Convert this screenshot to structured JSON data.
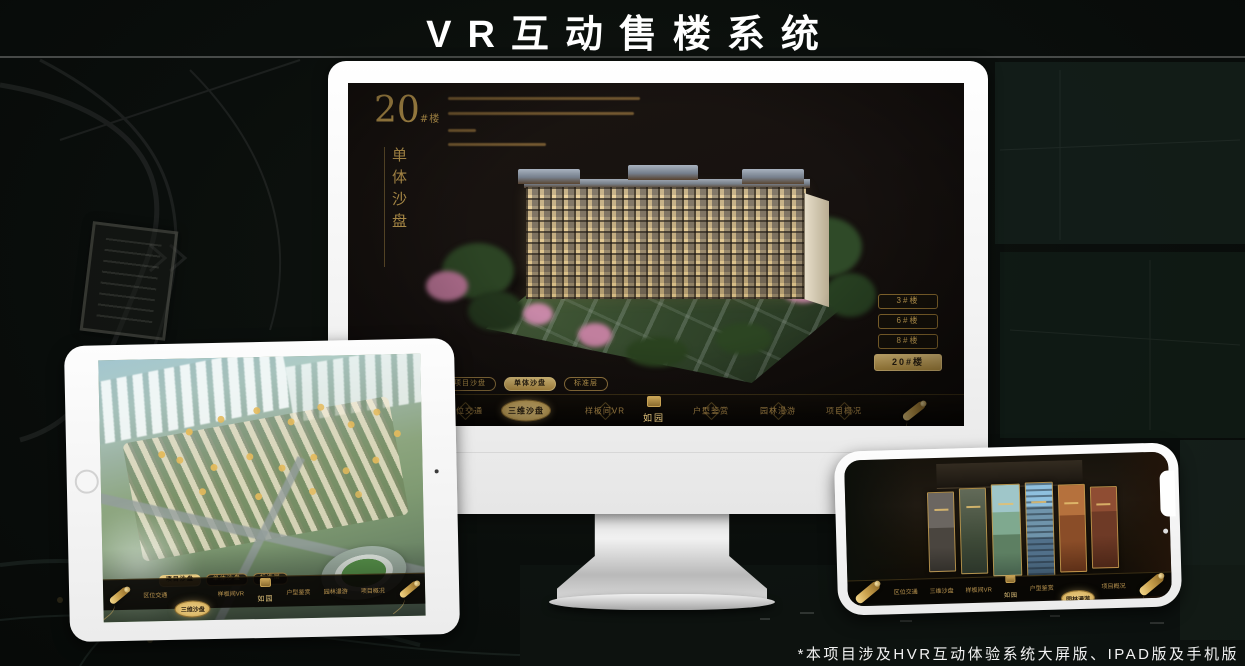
{
  "header": {
    "title": "VR互动售楼系统"
  },
  "footer": {
    "caption": "*本项目涉及HVR互动体验系统大屏版、IPAD版及手机版"
  },
  "brand": {
    "logo_text": "如园"
  },
  "colors": {
    "gold": "#c9a354",
    "gold_bright": "#e7c77e",
    "gold_deep": "#8a6b2f",
    "screen_bg": "#16110d",
    "nav_bg": "#0b0806",
    "page_bg": "#0b0f0d",
    "active_text": "#2a2012"
  },
  "nav": {
    "items": [
      "区位交通",
      "三维沙盘",
      "样板间VR",
      "户型鉴赏",
      "园林漫游",
      "项目概况"
    ]
  },
  "view_tabs": [
    "项目沙盘",
    "单体沙盘",
    "标准层"
  ],
  "desktop": {
    "block_number": "20",
    "block_suffix": "#楼",
    "subtitle_vertical": "单体沙盘",
    "floor_buttons": [
      "3#楼",
      "6#楼",
      "8#楼",
      "20#楼"
    ],
    "active_floor": "20#楼",
    "active_tab": "单体沙盘",
    "active_nav": "三维沙盘"
  },
  "tablet": {
    "active_tab": "项目沙盘",
    "active_nav": "三维沙盘"
  },
  "phone": {
    "active_nav": "园林漫游"
  }
}
